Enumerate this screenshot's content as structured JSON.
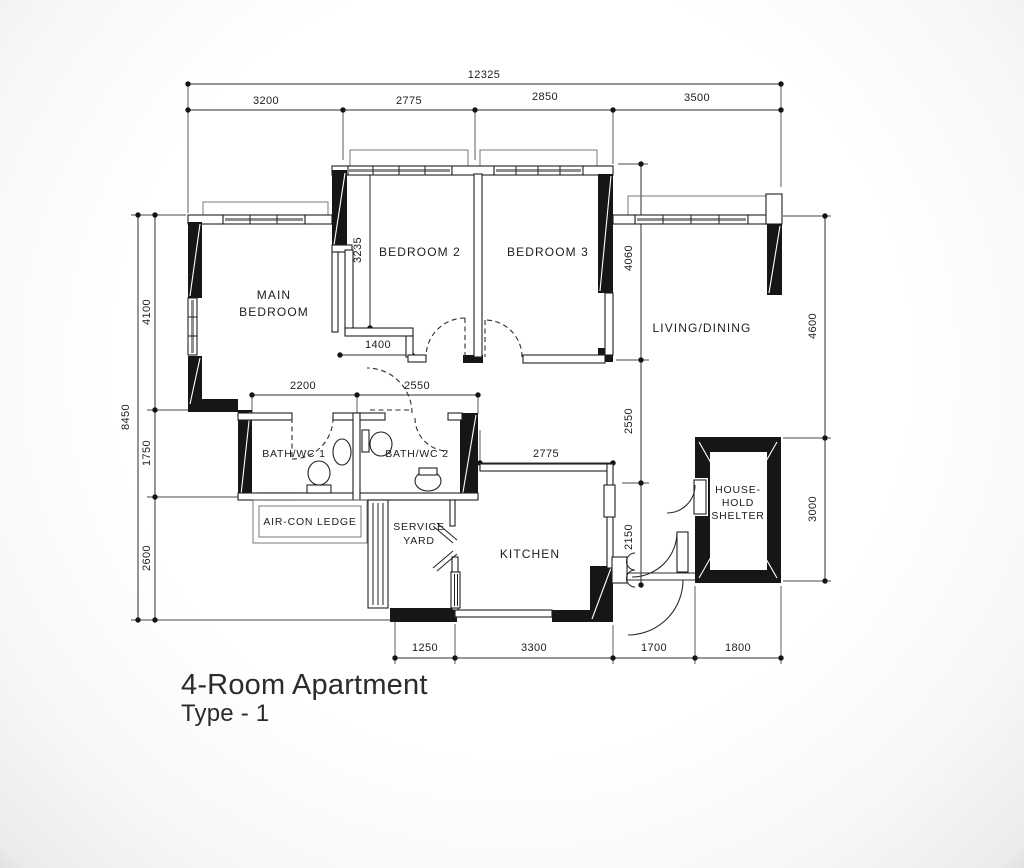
{
  "document": {
    "title_line1": "4-Room Apartment",
    "title_line2": "Type - 1"
  },
  "rooms": {
    "main_bedroom": [
      "MAIN",
      "BEDROOM"
    ],
    "bedroom2": "BEDROOM 2",
    "bedroom3": "BEDROOM 3",
    "living_dining": "LIVING/DINING",
    "bath1": "BATH/WC 1",
    "bath2": "BATH/WC 2",
    "aircon_ledge": "AIR-CON LEDGE",
    "service_yard": [
      "SERVICE",
      "YARD"
    ],
    "kitchen": "KITCHEN",
    "household_shelter": [
      "HOUSE-",
      "HOLD",
      "SHELTER"
    ]
  },
  "dims": {
    "overall_top": "12325",
    "top": [
      "3200",
      "2775",
      "2850",
      "3500"
    ],
    "overall_left": "8450",
    "left": [
      "4100",
      "1750",
      "2600"
    ],
    "right": [
      "4600",
      "3000"
    ],
    "bottom": [
      "1250",
      "3300",
      "1700",
      "1800"
    ],
    "bed2_height": "3235",
    "bed2_bottom": "1400",
    "bath1_width": "2200",
    "bath2_width": "2550",
    "kitchen_width": "2775",
    "col_4060": "4060",
    "col_2550": "2550",
    "col_2150": "2150"
  },
  "colors": {
    "ink": "#1d1d1d",
    "wall": "#161616",
    "paper": "#ffffff"
  }
}
